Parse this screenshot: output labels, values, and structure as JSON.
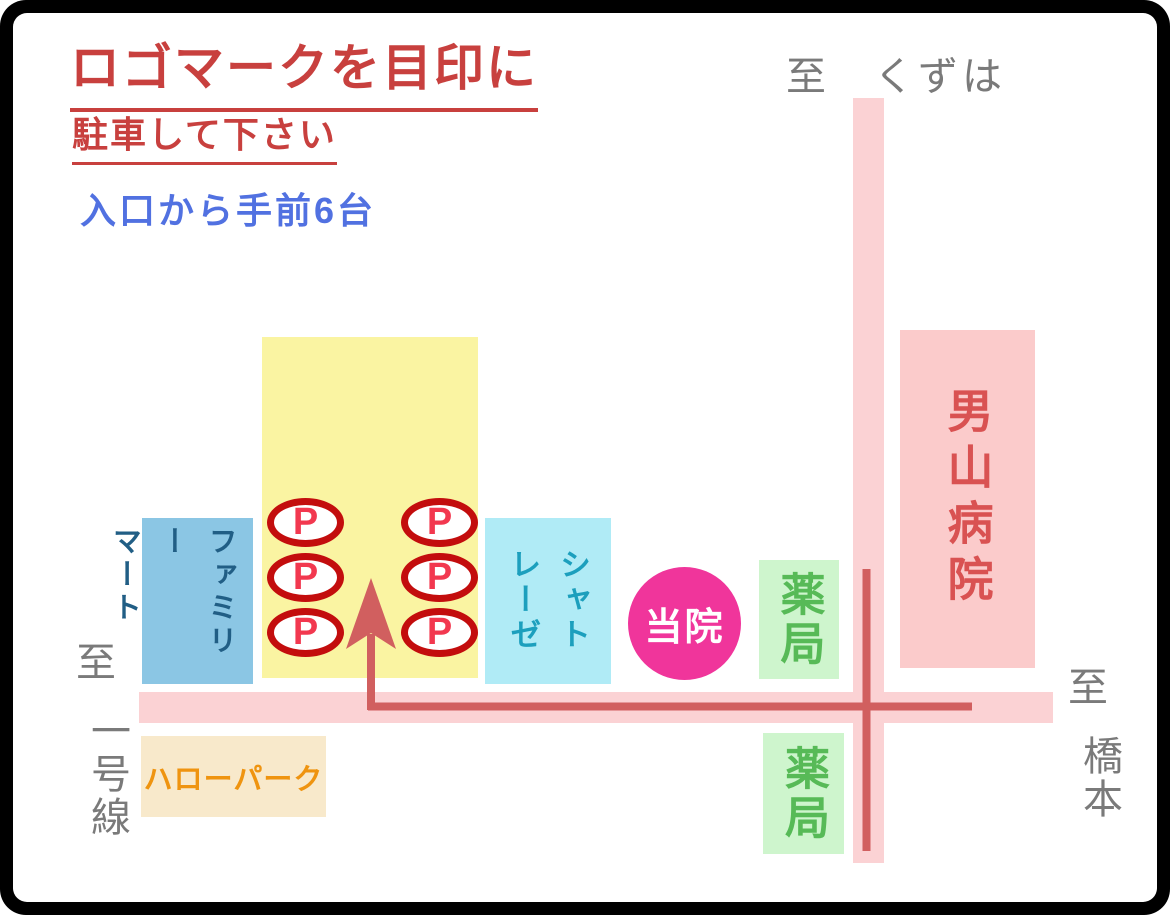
{
  "header": {
    "title": "ロゴマークを目印に",
    "subtitle": "駐車して下さい",
    "note": "入口から手前6台"
  },
  "directions": {
    "north": "至　くずは",
    "west": {
      "to": "至",
      "dest": "一号線"
    },
    "east": {
      "to": "至",
      "dest": "橋本"
    }
  },
  "landmarks": {
    "hospital": {
      "label": "男山病院"
    },
    "convenience_store": {
      "label": "ファミリーマート",
      "col1": "ファミリー",
      "col2": "マート"
    },
    "sweets_shop": {
      "label": "シャトレーゼ",
      "col1": "シャト",
      "col2": "レーゼ"
    },
    "clinic": {
      "label": "当院"
    },
    "pharmacy_north": {
      "label": "薬局"
    },
    "pharmacy_south": {
      "label": "薬局"
    },
    "hello_park": {
      "label": "ハローパーク"
    }
  },
  "parking": {
    "spot_label": "P",
    "count": 6
  },
  "colors": {
    "title_red": "#c8403e",
    "note_blue": "#5171e1",
    "direction_gray": "#7a7a7a",
    "road_pink": "#fbd2d4",
    "route_red": "#d15f5f",
    "hospital_bg": "#fbcbcb",
    "hospital_text": "#d95252",
    "parking_area_yellow": "#faf4a2",
    "spot_border_red": "#c30d0d",
    "spot_p_red": "#f2384f",
    "convenience_bg": "#8bc6e4",
    "convenience_text": "#215e85",
    "sweets_bg": "#b0ebf6",
    "sweets_text": "#1c9fbd",
    "clinic_pink": "#f0359b",
    "pharmacy_bg": "#cef5cd",
    "pharmacy_text": "#57ba57",
    "hello_park_bg": "#f8e9cb",
    "hello_park_text": "#ef9410"
  }
}
